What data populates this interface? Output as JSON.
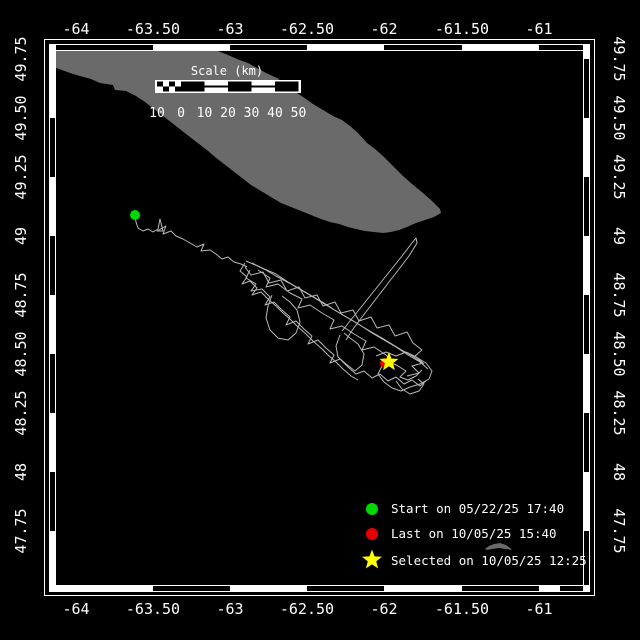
{
  "figure": {
    "background_color": "#000000",
    "frame_color": "#ffffff"
  },
  "axes": {
    "lon_labels": [
      "-64",
      "-63.50",
      "-63",
      "-62.50",
      "-62",
      "-61.50",
      "-61"
    ],
    "lat_labels": [
      "49.75",
      "49.50",
      "49.25",
      "49",
      "48.75",
      "48.50",
      "48.25",
      "48",
      "47.75"
    ]
  },
  "scale_bar": {
    "title": "Scale (km)",
    "tick_labels": [
      "10",
      "0",
      "10",
      "20",
      "30",
      "40",
      "50"
    ],
    "units": "km"
  },
  "legend": [
    {
      "marker": "green-circle",
      "color": "#00d900",
      "label": "Start on 05/22/25 17:40"
    },
    {
      "marker": "red-circle",
      "color": "#e80000",
      "label": "Last on 10/05/25 15:40"
    },
    {
      "marker": "yellow-star",
      "color": "#ffff00",
      "label": "Selected on 10/05/25 12:25"
    }
  ],
  "map": {
    "land_color": "#6a6a6a",
    "track_color": "#b8b8b8"
  }
}
